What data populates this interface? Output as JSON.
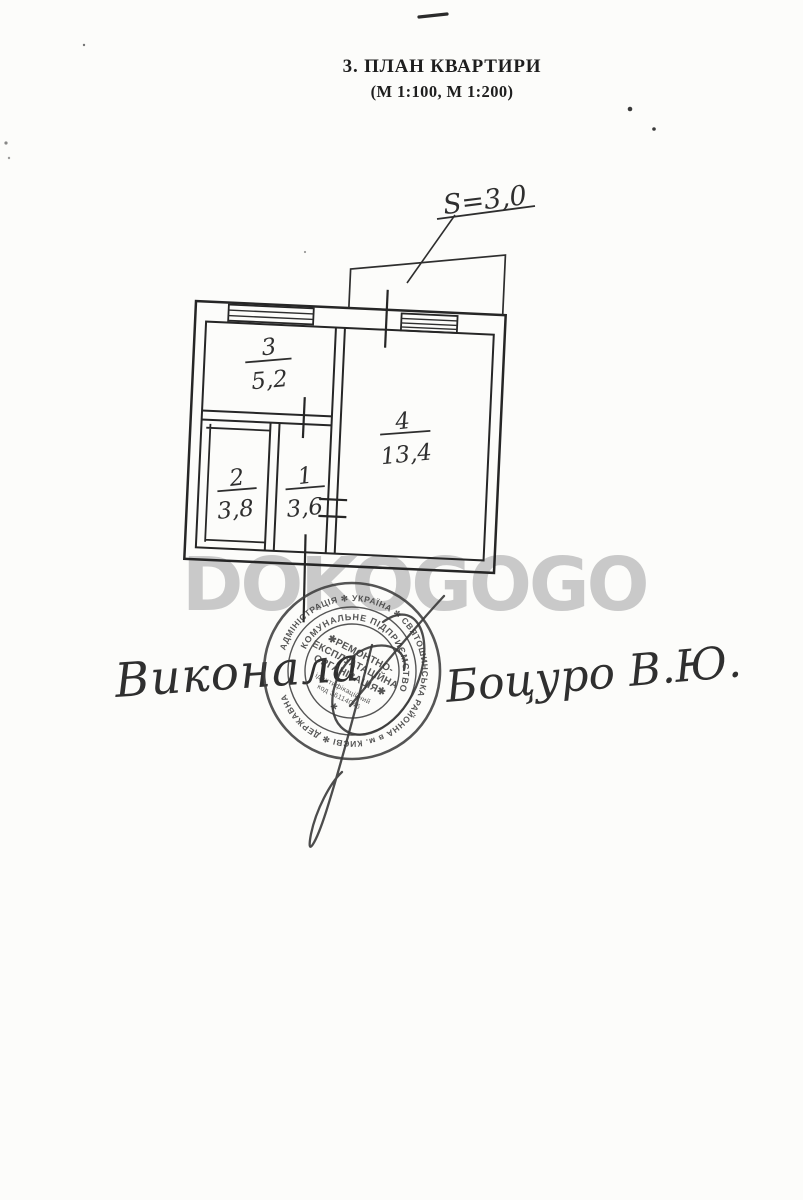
{
  "document": {
    "title": "3.  ПЛАН КВАРТИРИ",
    "subtitle": "(М 1:100, М 1:200)"
  },
  "watermark": {
    "text": "DOKOGOGO"
  },
  "plan": {
    "balcony_area_label": "S=3,0",
    "rooms": [
      {
        "number": "3",
        "area": "5,2"
      },
      {
        "number": "4",
        "area": "13,4"
      },
      {
        "number": "2",
        "area": "3,8"
      },
      {
        "number": "1",
        "area": "3,6"
      }
    ]
  },
  "stamp": {
    "outer_ring": "АДМІНІСТРАЦІЯ ✻ УКРАЇНА ✻ СВЯТОШИНСЬКА РАЙОННА в м. КИЄВІ ✻ ДЕРЖАВНА",
    "inner_ring": "КОМУНАЛЬНЕ ПІДПРИЄМСТВО",
    "org_line1": "✱РЕМОНТНО-",
    "org_line2": "ЕКСПЛУАТАЦІЙНА",
    "org_line3": "ОРГАНІЗАЦІЯ✱",
    "id_line1": "ідентифікаційний",
    "id_line2": "код 36114046",
    "bottom_star": "✱"
  },
  "handwriting": {
    "executor": "Виконала",
    "signature_name": "Боцуро В.Ю."
  }
}
